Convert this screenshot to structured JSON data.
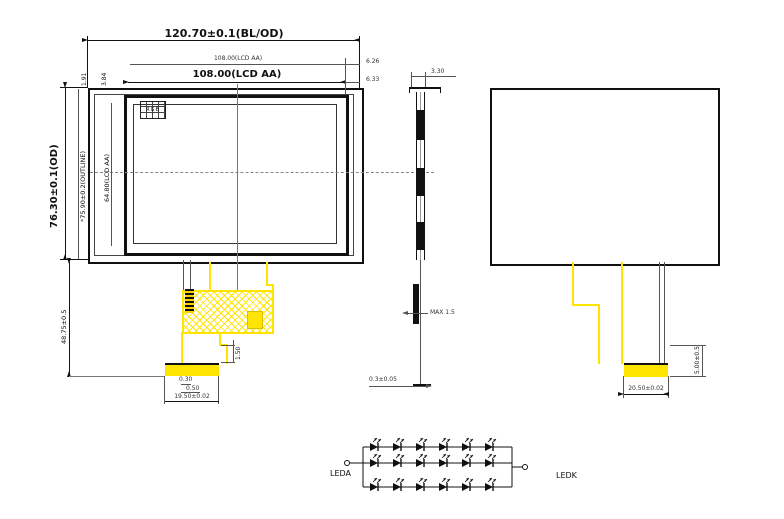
{
  "front": {
    "pixel_label": "RGB",
    "dims": {
      "od_width": "120.70±0.1(BL/OD)",
      "aa_width_ref": "108.00(LCD AA)",
      "aa_width": "108.00(LCD AA)",
      "gap_right_top": "6.26",
      "gap_right_bottom": "6.33",
      "od_height": "76.30±0.1(OD)",
      "outline_height": "*75.90±0.2(OUTLINE)",
      "aa_height": "64.80(LCD AA)",
      "edge_offset_a": "1.91",
      "edge_offset_b": "3.84",
      "fpc_drop": "48.75±0.5"
    }
  },
  "fpc": {
    "dims": {
      "bend_height": "1.50",
      "pad_width": "0.30",
      "pitch": "0.50",
      "connector_width": "19.50±0.02"
    }
  },
  "side": {
    "dims": {
      "thickness": "3.30",
      "component_height": "MAX 1.5",
      "fpc_thickness": "0.3±0.05"
    }
  },
  "back": {
    "dims": {
      "connector_width": "20.50±0.02",
      "connector_extension": "5.00±0.5"
    }
  },
  "led_circuit": {
    "anode_label": "LEDA",
    "cathode_label": "LEDK",
    "rows": 3,
    "leds_per_row": 6
  },
  "colors": {
    "fpc_yellow": "#ffe400",
    "line": "#111111"
  }
}
